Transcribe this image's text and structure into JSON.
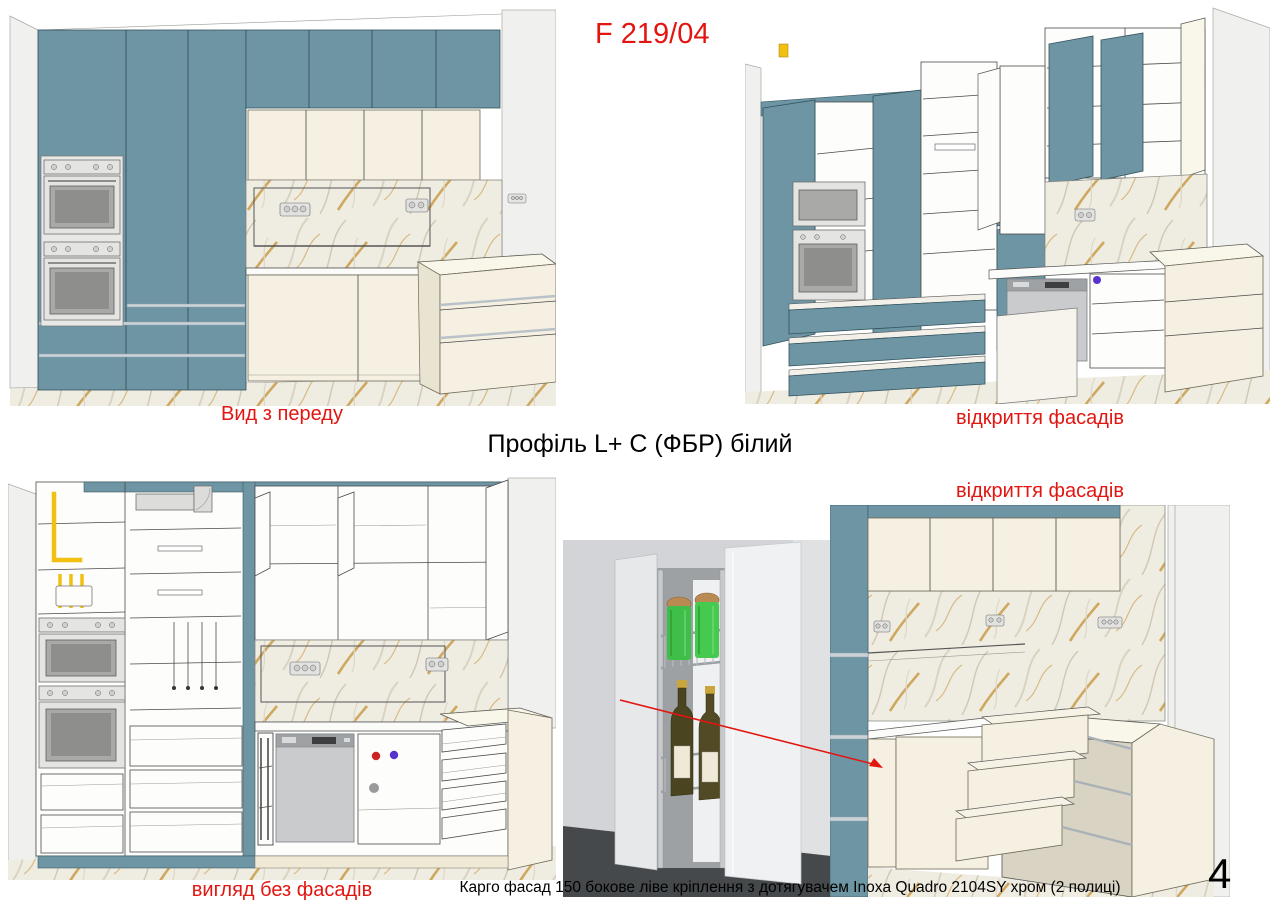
{
  "page": {
    "code": "F 219/04",
    "title": "Профіль L+ C (ФБР) білий",
    "caption": "Карго фасад 150 бокове ліве кріплення з дотягувачем Inoxa Quadro 2104SY хром (2 полиці)",
    "page_number": "4"
  },
  "views": {
    "front": {
      "label": "Вид з переду"
    },
    "open_top": {
      "label": "відкриття фасадів"
    },
    "no_facades": {
      "label": "вигляд без фасадів"
    },
    "corner_open": {
      "label": "відкриття фасадів"
    }
  },
  "colors": {
    "accent-red": "#e31510",
    "teal": "#6d95a4",
    "teal-dark": "#32525d",
    "cream": "#f5f0e1",
    "gold": "#c49134",
    "metal": "#ccd3d8",
    "text": "#111111"
  }
}
